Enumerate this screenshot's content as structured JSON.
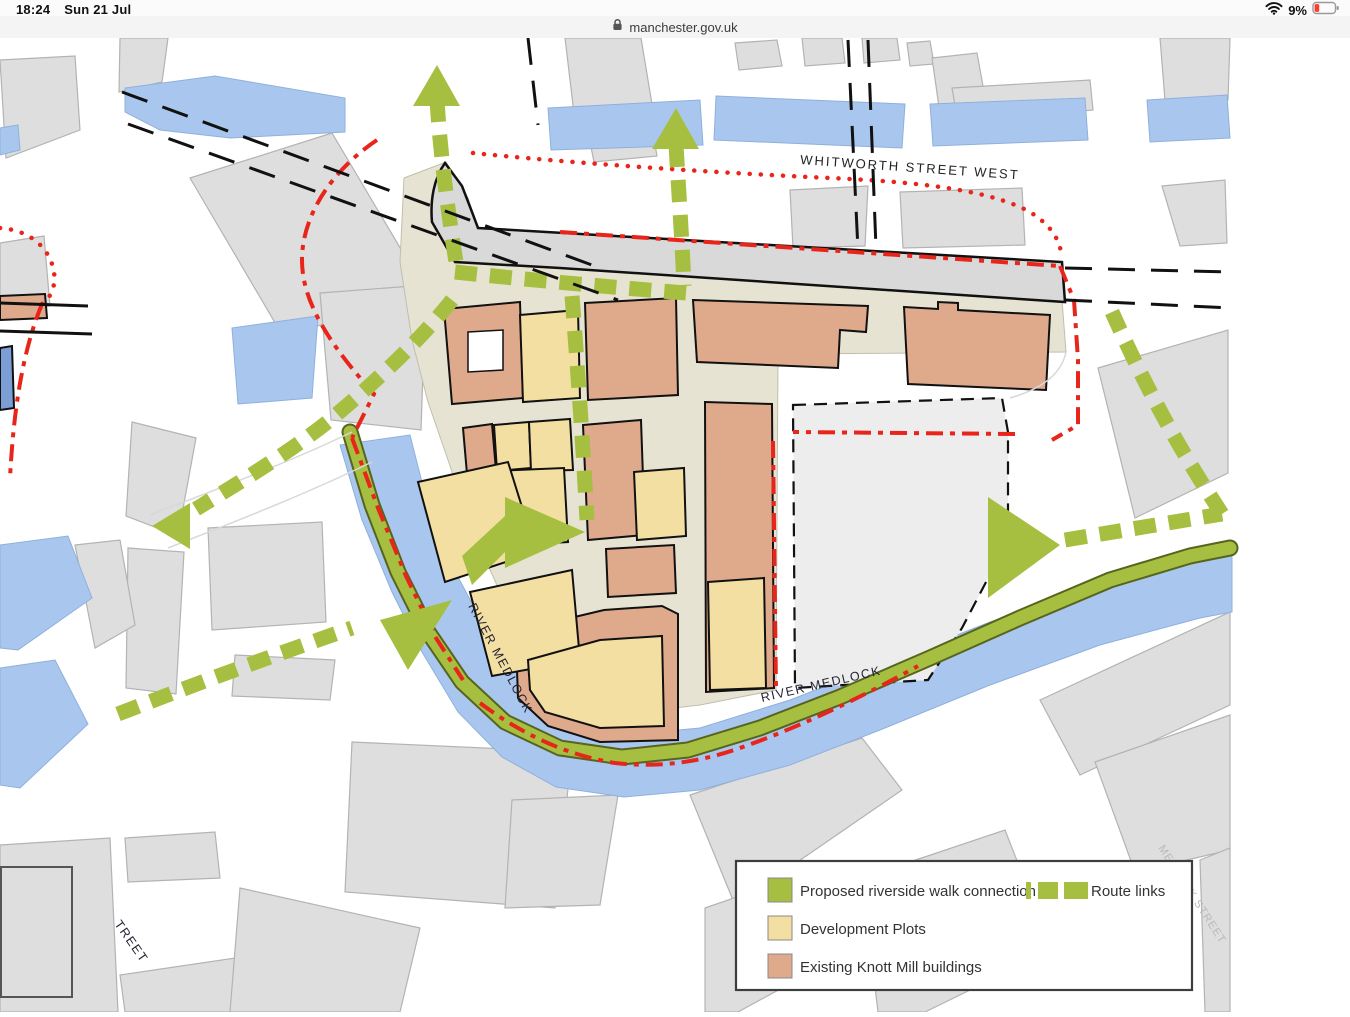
{
  "status_bar": {
    "time": "18:24",
    "date": "Sun 21 Jul",
    "battery_percent": "9%"
  },
  "url_bar": {
    "domain": "manchester.gov.uk"
  },
  "map": {
    "labels": {
      "whitworth_street": "WHITWORTH STREET WEST",
      "river_medlock_west": "RIVER MEDLOCK",
      "river_medlock_south": "RIVER MEDLOCK",
      "street_partial": "TREET",
      "medlock_street": "MEDLOCK STREET"
    },
    "legend": {
      "walk_label": "Proposed riverside walk connection",
      "route_links_label": "Route links",
      "plots_label": "Development Plots",
      "existing_label": "Existing Knott Mill buildings"
    },
    "colors": {
      "route_green": "#a6bf41",
      "water_blue": "#a9c7ee",
      "dark_water": "#7b9fd4",
      "development_yellow": "#f4dfa2",
      "existing_salmon": "#dfa98c",
      "boundary_red": "#e8251a",
      "context_gray": "#dedede",
      "context_stroke": "#b3b3b3",
      "site_beige": "#e7e3d3",
      "rail_gray": "#d9d9d9",
      "future_gray": "#ededed",
      "outline_black": "#111111"
    }
  }
}
